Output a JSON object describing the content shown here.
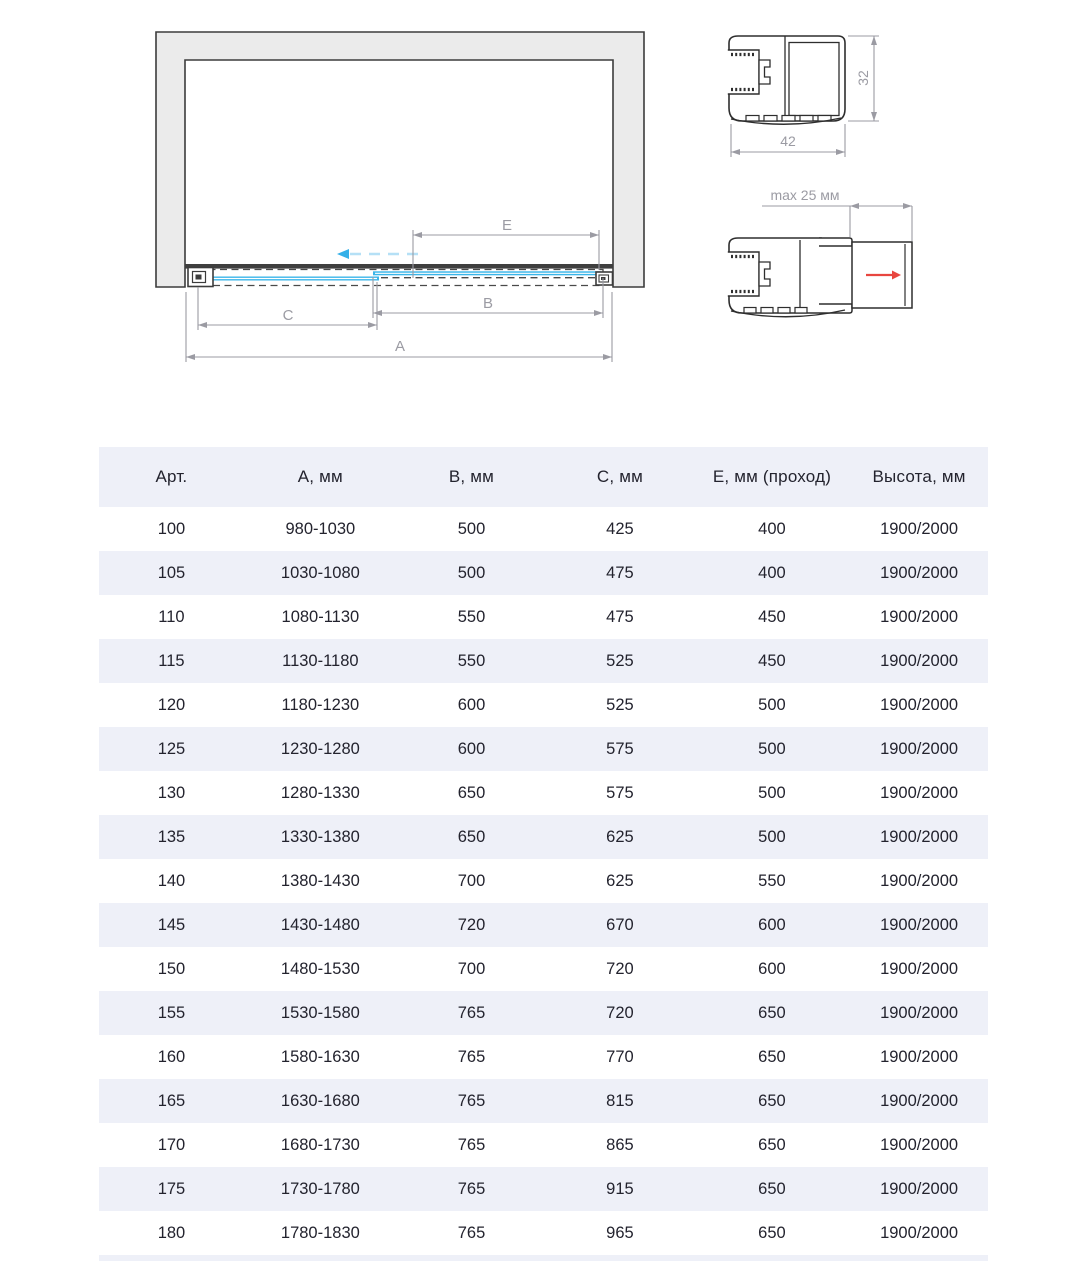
{
  "diagram": {
    "plan_view": {
      "dim_labels": {
        "a": "A",
        "b": "B",
        "c": "C",
        "e": "E"
      }
    },
    "profiles": {
      "width_label": "42",
      "height_label": "32",
      "adjustment_label": "max 25 мм"
    },
    "colors": {
      "glass_blue": "#3ab5e9",
      "glass_motion_dash": "#b5e0f6",
      "motion_arrowhead": "#35b0e8",
      "wall_fill": "#ebebeb",
      "outline_dark": "#2e2e2e",
      "track_dark": "#3f3f3f",
      "dimension_gray": "#9b9ba3",
      "direction_arrow_red": "#e8463f",
      "table_band": "#eef0f8",
      "table_text": "#23232e"
    }
  },
  "table": {
    "headers": [
      "Арт.",
      "А, мм",
      "В, мм",
      "С, мм",
      "Е, мм (проход)",
      "Высота, мм"
    ],
    "rows": [
      [
        "100",
        "980-1030",
        "500",
        "425",
        "400",
        "1900/2000"
      ],
      [
        "105",
        "1030-1080",
        "500",
        "475",
        "400",
        "1900/2000"
      ],
      [
        "110",
        "1080-1130",
        "550",
        "475",
        "450",
        "1900/2000"
      ],
      [
        "115",
        "1130-1180",
        "550",
        "525",
        "450",
        "1900/2000"
      ],
      [
        "120",
        "1180-1230",
        "600",
        "525",
        "500",
        "1900/2000"
      ],
      [
        "125",
        "1230-1280",
        "600",
        "575",
        "500",
        "1900/2000"
      ],
      [
        "130",
        "1280-1330",
        "650",
        "575",
        "500",
        "1900/2000"
      ],
      [
        "135",
        "1330-1380",
        "650",
        "625",
        "500",
        "1900/2000"
      ],
      [
        "140",
        "1380-1430",
        "700",
        "625",
        "550",
        "1900/2000"
      ],
      [
        "145",
        "1430-1480",
        "720",
        "670",
        "600",
        "1900/2000"
      ],
      [
        "150",
        "1480-1530",
        "700",
        "720",
        "600",
        "1900/2000"
      ],
      [
        "155",
        "1530-1580",
        "765",
        "720",
        "650",
        "1900/2000"
      ],
      [
        "160",
        "1580-1630",
        "765",
        "770",
        "650",
        "1900/2000"
      ],
      [
        "165",
        "1630-1680",
        "765",
        "815",
        "650",
        "1900/2000"
      ],
      [
        "170",
        "1680-1730",
        "765",
        "865",
        "650",
        "1900/2000"
      ],
      [
        "175",
        "1730-1780",
        "765",
        "915",
        "650",
        "1900/2000"
      ],
      [
        "180",
        "1780-1830",
        "765",
        "965",
        "650",
        "1900/2000"
      ]
    ]
  }
}
